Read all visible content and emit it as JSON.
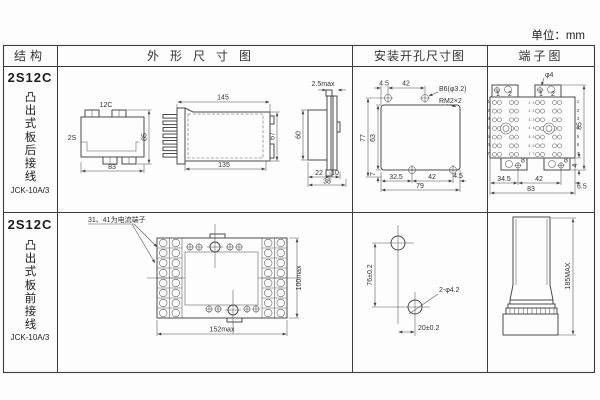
{
  "page": {
    "unit": "单位：mm"
  },
  "header": {
    "structure": "结构",
    "outline": "外形尺寸图",
    "mounting": "安装开孔尺寸图",
    "terminal": "端子图"
  },
  "row1": {
    "model": "2S12C",
    "wiring": "凸出式板后接线",
    "code": "JCK-10A/3",
    "outline": {
      "front": {
        "top": "12C",
        "side": "2S",
        "height": "85",
        "width": "83"
      },
      "side": {
        "top_width": "145",
        "bottom_width": "135",
        "height": "67"
      },
      "panel": {
        "clearance": "2.5max",
        "height": "60",
        "depth": "22",
        "panel_thk": "10",
        "total_depth": "38"
      }
    },
    "mounting": {
      "top_offset": "4.5",
      "top_pitch": "42",
      "hole": "B6(φ3.2)",
      "corner": "RM2×2",
      "height_total": "77",
      "height_opening": "63",
      "bottom_margin": "7",
      "bottom_offset": "32.5",
      "bottom_pitch": "42",
      "bottom_edge": "4.5",
      "width_total": "79"
    },
    "terminal": {
      "hole": "φ4",
      "col1": "1",
      "col2": "2",
      "screw": "8",
      "rows": "1\n2\n3\n4\n5\n6\n7",
      "height": "85",
      "tab": "4",
      "left": "34.5",
      "pitch": "42",
      "right": "6.5",
      "width": "83"
    }
  },
  "row2": {
    "model": "2S12C",
    "wiring": "凸出式板前接线",
    "code": "JCK-10A/3",
    "outline": {
      "note": "31、41为电流端子",
      "width": "152max",
      "height": "100max"
    },
    "mounting": {
      "pitch_v": "76±0.2",
      "hole": "2-φ4.2",
      "pitch_h": "20±0.2"
    },
    "profile": {
      "height": "185MAX"
    }
  }
}
